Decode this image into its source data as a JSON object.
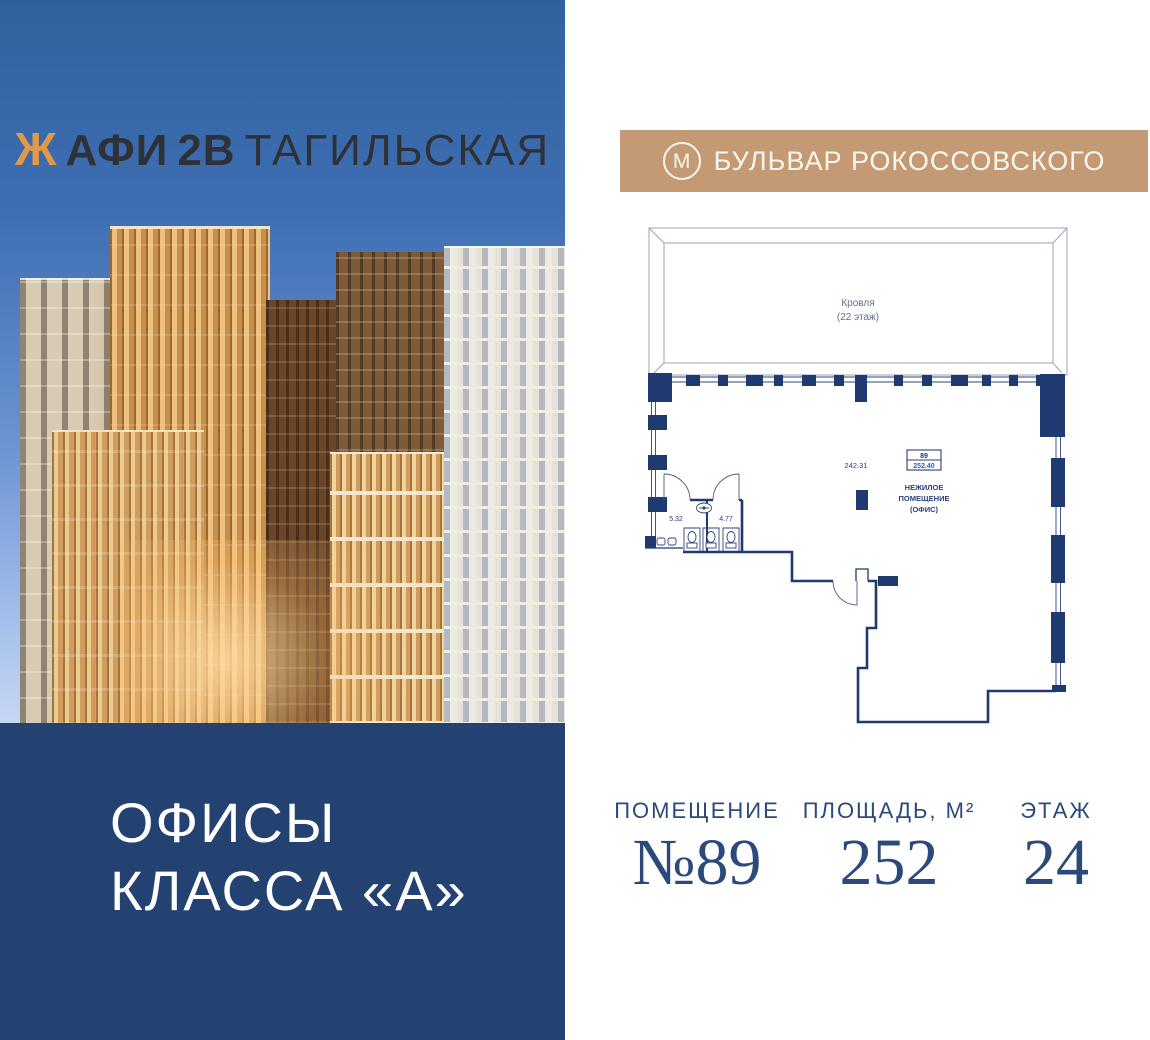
{
  "left_panel": {
    "logo": {
      "glyph": "Ж",
      "brand": "АФИ",
      "block": "2В",
      "name": "ТАГИЛЬСКАЯ"
    },
    "tagline_line1": "ОФИСЫ",
    "tagline_line2": "КЛАССА «А»"
  },
  "right_panel": {
    "metro": {
      "symbol": "М",
      "station": "БУЛЬВАР РОКОССОВСКОГО"
    },
    "floor_plan": {
      "roof_label_line1": "Кровля",
      "roof_label_line2": "(22 этаж)",
      "area_inline": "242.31",
      "unit_box_number": "89",
      "unit_box_area": "252.40",
      "unit_type_line1": "НЕЖИЛОЕ",
      "unit_type_line2": "ПОМЕЩЕНИЕ",
      "unit_type_line3": "(ОФИС)",
      "wc_left_area": "5.32",
      "wc_right_area": "4.77"
    },
    "stats": [
      {
        "label": "ПОМЕЩЕНИЕ",
        "value": "№89"
      },
      {
        "label": "ПЛОЩАДЬ, М²",
        "value": "252"
      },
      {
        "label": "ЭТАЖ",
        "value": "24"
      }
    ]
  },
  "colors": {
    "navy_panel": "#234271",
    "plan_walls": "#1f3a70",
    "plan_light_line": "#9aa3b8",
    "stats_text": "#2b4a7b",
    "metro_badge": "#c49a74",
    "logo_accent": "#e09a47",
    "logo_text": "#2e3138",
    "gold_facade": "#eec17f"
  }
}
